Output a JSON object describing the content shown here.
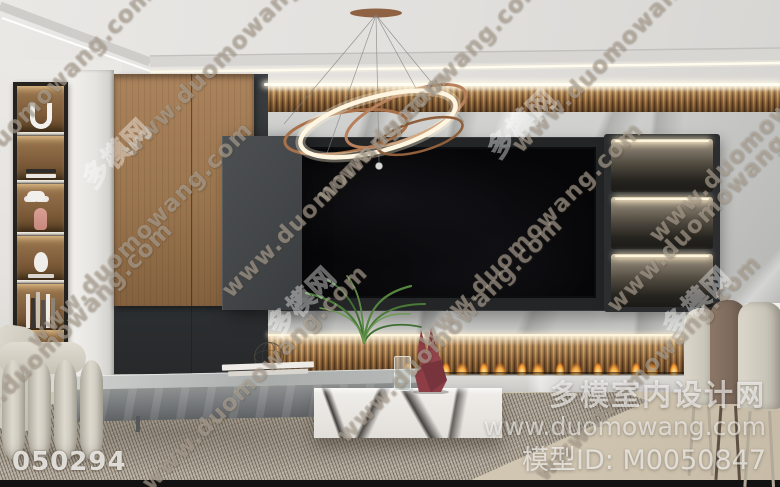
{
  "watermarks": {
    "diagonal": "www.duomowang.com",
    "diagonal_cn": "多模网",
    "photo_id": "050294",
    "site_name": "多模室内设计网",
    "site_url": "www.duomowang.com",
    "model_id": "模型ID: M0050847"
  },
  "palette": {
    "wood": "#a0763f",
    "charcoal_panel": "#35383a",
    "marble": "#cbccca",
    "led_warm": "#fff6df",
    "flame_orange": "#ff9d3a",
    "rabbit_maroon": "#8c3d46",
    "rug": "#b0a798",
    "floor": "#c9bda8",
    "chair_cream": "#d8d3c7",
    "chair_brown": "#8d7868"
  }
}
